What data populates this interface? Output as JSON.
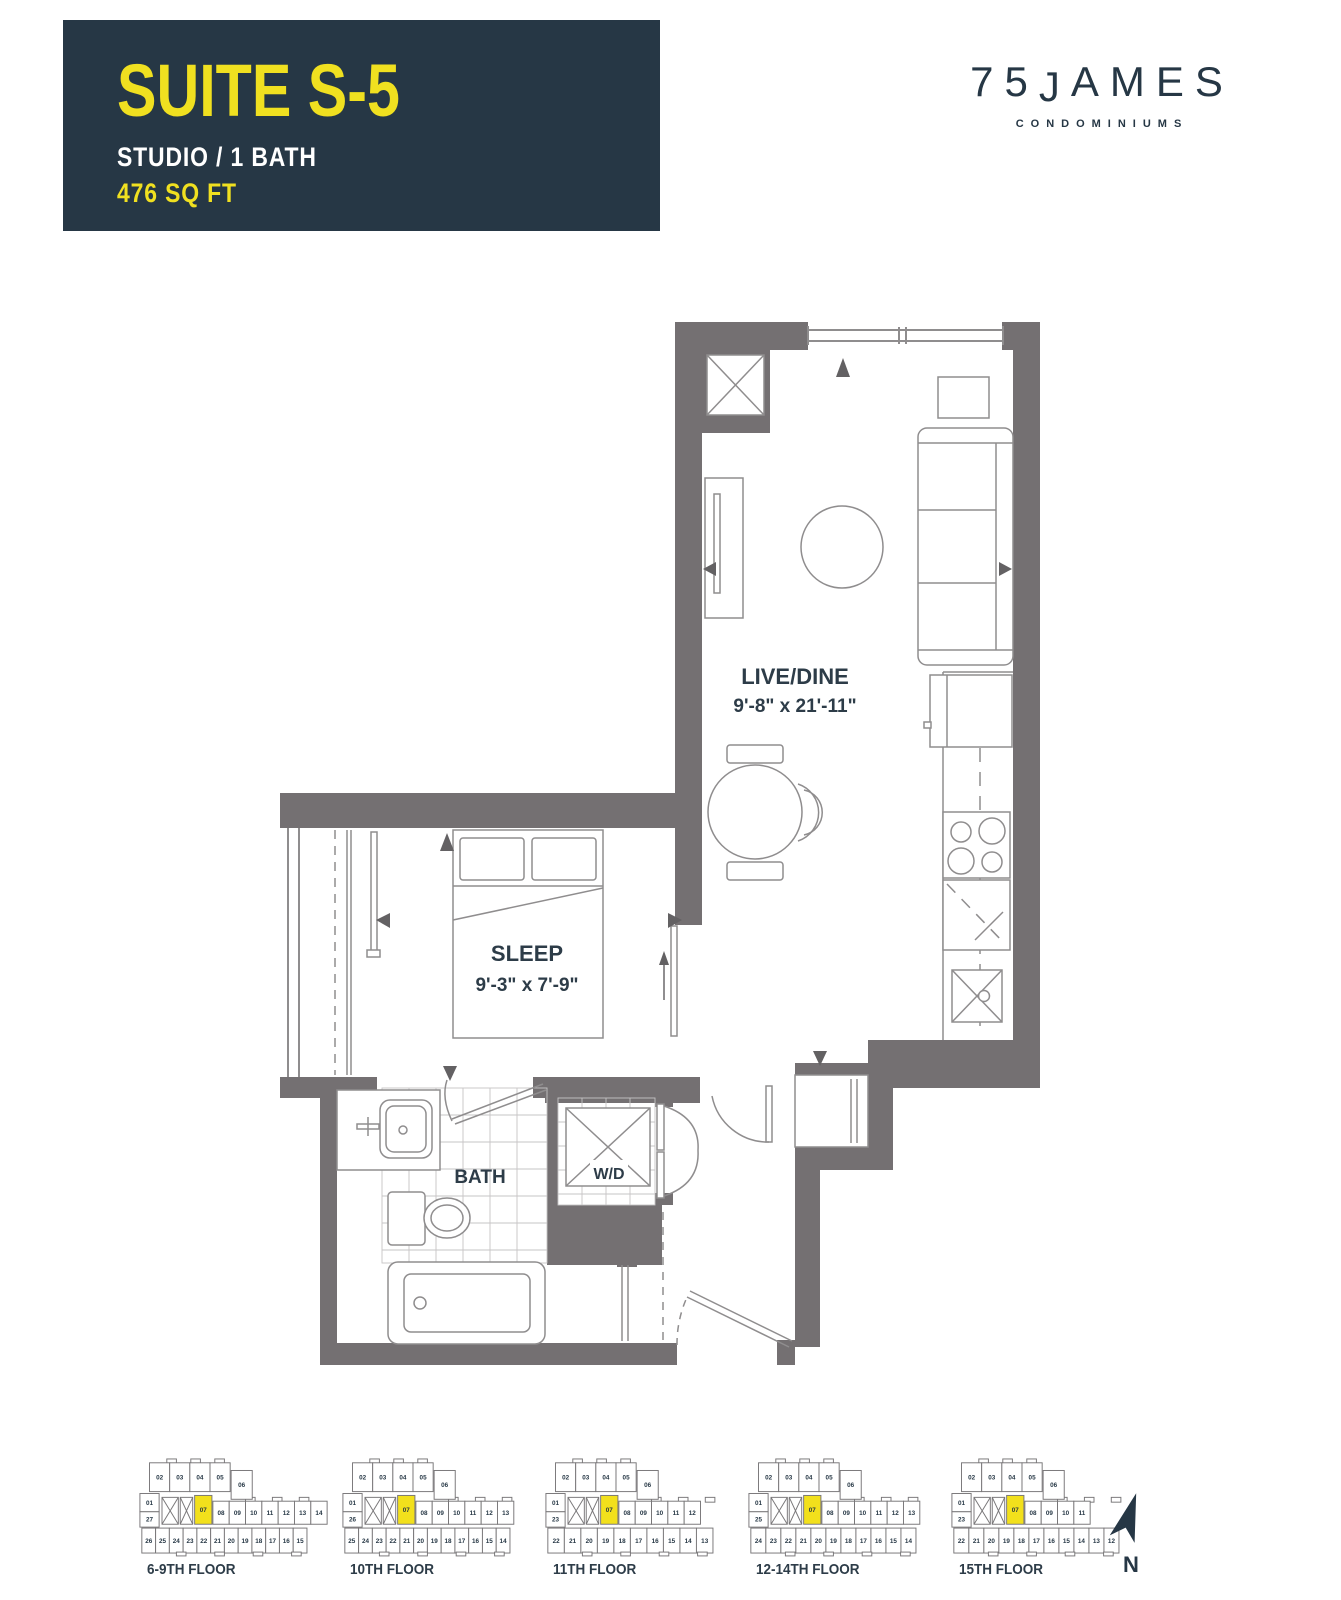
{
  "title_block": {
    "suite": "SUITE S-5",
    "type": "STUDIO / 1 BATH",
    "area": "476 SQ FT"
  },
  "logo": {
    "number": "75",
    "j": "J",
    "rest": "AMES",
    "subtitle": "CONDOMINIUMS"
  },
  "plan": {
    "live_dine": {
      "name": "LIVE/DINE",
      "dims": "9'-8\" x 21'-11\""
    },
    "sleep": {
      "name": "SLEEP",
      "dims": "9'-3\" x 7'-9\""
    },
    "bath": {
      "name": "BATH"
    },
    "wd": {
      "name": "W/D"
    }
  },
  "key_plans": [
    {
      "label": "6-9TH FLOOR",
      "top": [
        "02",
        "03",
        "04",
        "05",
        "06"
      ],
      "left": [
        "01",
        "27"
      ],
      "mid": [
        "07",
        "08",
        "09",
        "10",
        "11",
        "12",
        "13",
        "14"
      ],
      "bottom": [
        "26",
        "25",
        "24",
        "23",
        "22",
        "21",
        "20",
        "19",
        "18",
        "17",
        "16",
        "15"
      ],
      "highlight": "07"
    },
    {
      "label": "10TH FLOOR",
      "top": [
        "02",
        "03",
        "04",
        "05",
        "06"
      ],
      "left": [
        "01",
        "26"
      ],
      "mid": [
        "07",
        "08",
        "09",
        "10",
        "11",
        "12",
        "13"
      ],
      "bottom": [
        "25",
        "24",
        "23",
        "22",
        "21",
        "20",
        "19",
        "18",
        "17",
        "16",
        "15",
        "14"
      ],
      "highlight": "07"
    },
    {
      "label": "11TH FLOOR",
      "top": [
        "02",
        "03",
        "04",
        "05",
        "06"
      ],
      "left": [
        "01",
        "23"
      ],
      "mid": [
        "07",
        "08",
        "09",
        "10",
        "11",
        "12"
      ],
      "bottom": [
        "22",
        "21",
        "20",
        "19",
        "18",
        "17",
        "16",
        "15",
        "14",
        "13"
      ],
      "highlight": "07"
    },
    {
      "label": "12-14TH FLOOR",
      "top": [
        "02",
        "03",
        "04",
        "05",
        "06"
      ],
      "left": [
        "01",
        "25"
      ],
      "mid": [
        "07",
        "08",
        "09",
        "10",
        "11",
        "12",
        "13"
      ],
      "bottom": [
        "24",
        "23",
        "22",
        "21",
        "20",
        "19",
        "18",
        "17",
        "16",
        "15",
        "14"
      ],
      "highlight": "07"
    },
    {
      "label": "15TH FLOOR",
      "top": [
        "02",
        "03",
        "04",
        "05",
        "06"
      ],
      "left": [
        "01",
        "23"
      ],
      "mid": [
        "07",
        "08",
        "09",
        "10",
        "11"
      ],
      "bottom": [
        "22",
        "21",
        "20",
        "19",
        "18",
        "17",
        "16",
        "15",
        "14",
        "13",
        "12"
      ],
      "highlight": "07"
    }
  ],
  "compass": {
    "label": "N"
  },
  "colors": {
    "navy": "#263745",
    "yellow": "#F0E020",
    "highlight": "#F2E01C",
    "wall": "#747072",
    "line": "#8f8d8e",
    "text": "#2d3c48"
  }
}
